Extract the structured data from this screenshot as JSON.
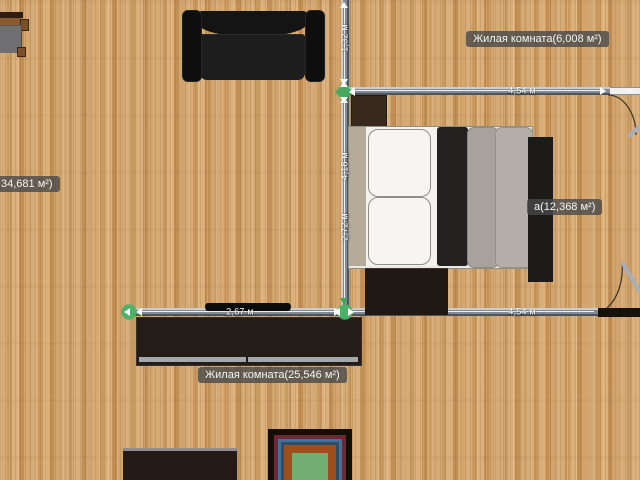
{
  "app": {
    "name": "floor-plan-editor",
    "view": "2d-plan"
  },
  "rooms": [
    {
      "label": "Жилая комната(6,008 м²)"
    },
    {
      "label": "а(12,368 м²)"
    },
    {
      "label": "34,681 м²)"
    },
    {
      "label": "Жилая комната(25,546 м²)"
    }
  ],
  "dims": {
    "v_upper": "1,32 м",
    "v_mid": "4,18 м",
    "v_lower": "2,72 м",
    "top_wall": "4,54 м",
    "bottom_wall_selected": "2,67 м",
    "bottom_wall_right": "4,54 м"
  },
  "furniture": [
    "sideboard",
    "sofa",
    "nightstand",
    "double-bed",
    "bedside-unit",
    "wardrobe",
    "tv-stand",
    "tv",
    "cabinet",
    "rug"
  ],
  "colors": {
    "floor": "#d0a26a",
    "wall": "#828a95",
    "selection_green": "#46a85f",
    "label_bg": "rgba(72,72,74,0.8)",
    "sofa": "#161412",
    "rug_center": "#72ad72"
  }
}
